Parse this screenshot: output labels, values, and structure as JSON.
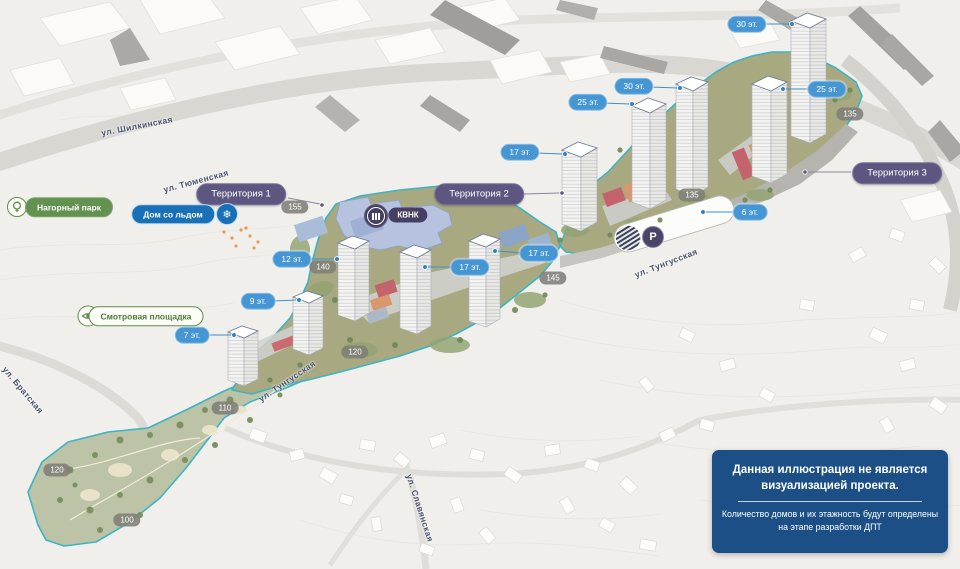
{
  "illustration": {
    "territories": [
      {
        "text": "Территория 1"
      },
      {
        "text": "Территория 2"
      },
      {
        "text": "Территория 3"
      }
    ],
    "floor_badges": [
      {
        "text": "30 эт."
      },
      {
        "text": "25 эт."
      },
      {
        "text": "30 эт."
      },
      {
        "text": "25 эт."
      },
      {
        "text": "17 эт."
      },
      {
        "text": "17 эт."
      },
      {
        "text": "17 эт."
      },
      {
        "text": "12 эт."
      },
      {
        "text": "9 эт."
      },
      {
        "text": "7 эт."
      },
      {
        "text": "6 эт."
      }
    ],
    "elevation_markers": [
      {
        "text": "155"
      },
      {
        "text": "140"
      },
      {
        "text": "145"
      },
      {
        "text": "135"
      },
      {
        "text": "135"
      },
      {
        "text": "120"
      },
      {
        "text": "120"
      },
      {
        "text": "110"
      },
      {
        "text": "100"
      }
    ],
    "streets": [
      {
        "text": "ул. Шилкинская"
      },
      {
        "text": "ул. Тюменская"
      },
      {
        "text": "ул. Тунгусская"
      },
      {
        "text": "ул. Тунгусская"
      },
      {
        "text": "ул. Братская"
      },
      {
        "text": "ул. Славянская"
      }
    ],
    "poi": {
      "park_label": "Нагорный парк",
      "ice_house_label": "Дом со льдом",
      "ice_glyph": "❄",
      "viewpoint_label": "Смотровая площадка",
      "kvnk_label": "КВНК",
      "parking_glyph": "P"
    },
    "disclaimer": {
      "title": "Данная иллюстрация не является визуализацией проекта.",
      "body": "Количество домов и их этажность будут определены на этапе разработки ДПТ"
    },
    "colors": {
      "floor_badge": "#4796d4",
      "territory_pill": "#5d5680",
      "elevation_marker": "#7f7e78",
      "park_pill": "#639150",
      "ice_pill": "#1a70b7",
      "kvnk_pill": "#454063",
      "site_outline": "#3db4c2",
      "disclaimer_bg": "#1b4f86"
    }
  }
}
